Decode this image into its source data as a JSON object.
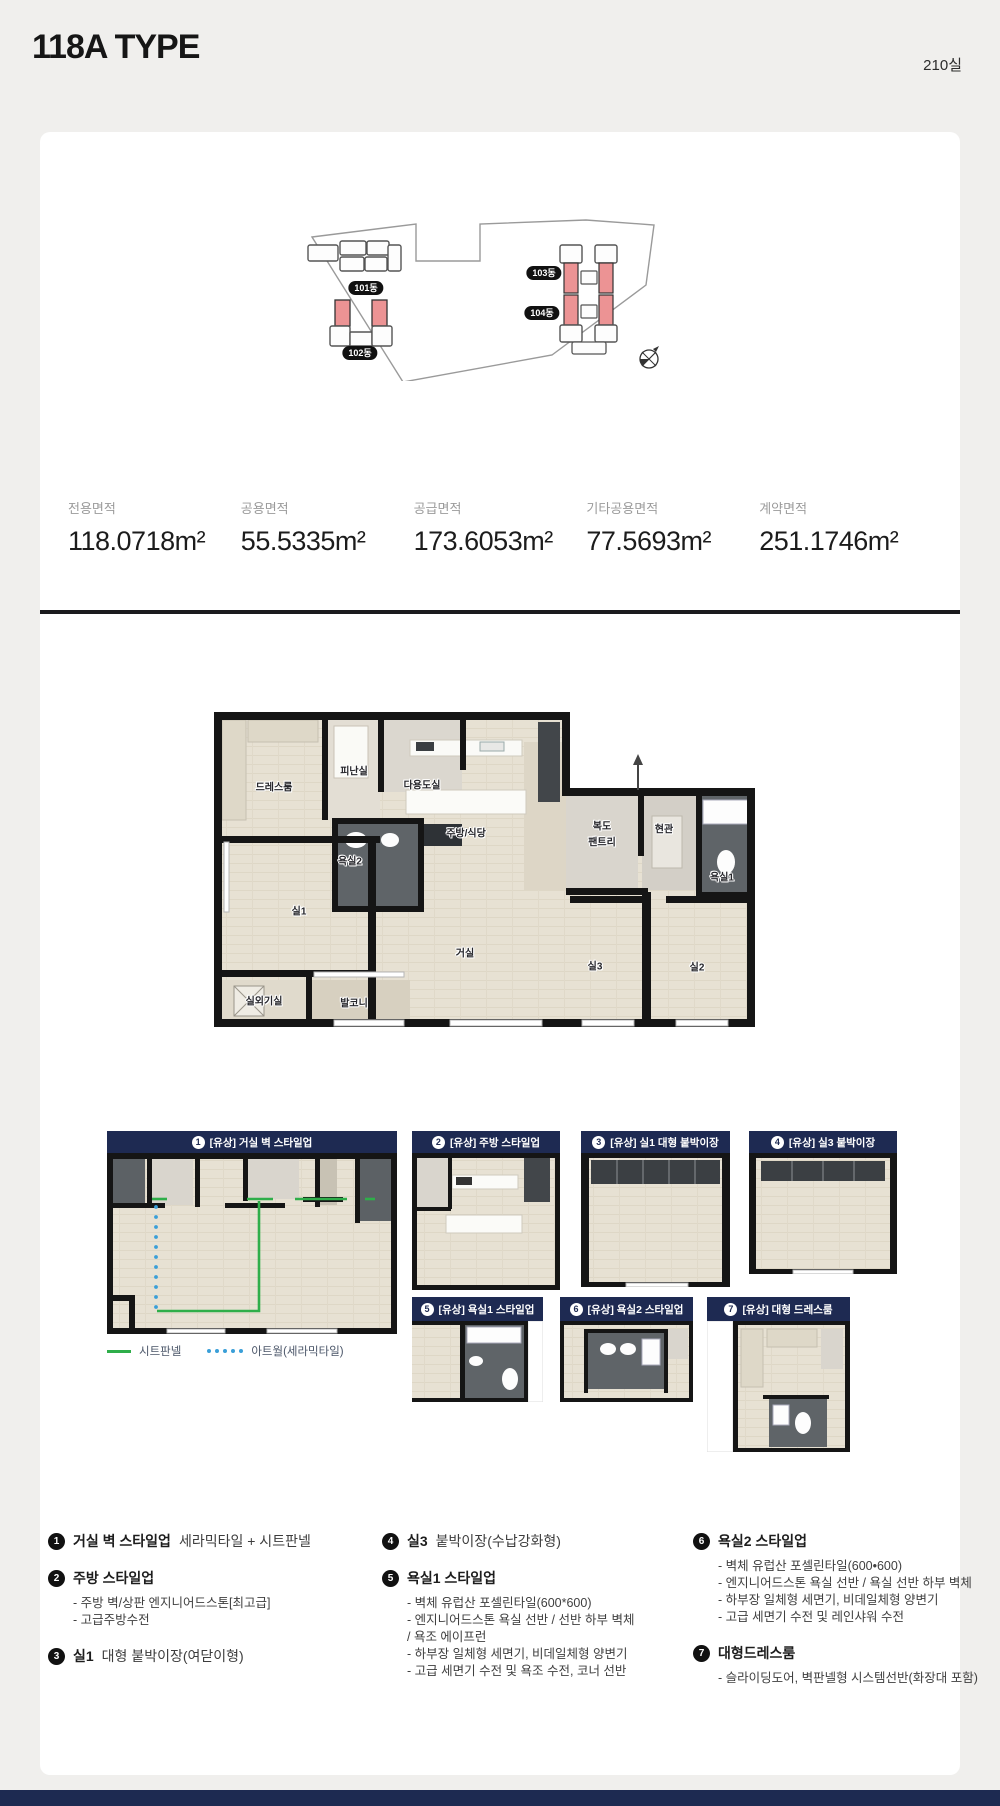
{
  "page": {
    "title": "118A TYPE",
    "unit_count": "210실"
  },
  "colors": {
    "navy": "#1e2a52",
    "highlight_red": "#ec9394",
    "green_line": "#2fae4a",
    "blue_dot": "#3a9fd8"
  },
  "site_plan": {
    "buildings": [
      {
        "label": "101동"
      },
      {
        "label": "102동"
      },
      {
        "label": "103동"
      },
      {
        "label": "104동"
      }
    ]
  },
  "specs": [
    {
      "label": "전용면적",
      "value": "118.0718m²"
    },
    {
      "label": "공용면적",
      "value": "55.5335m²"
    },
    {
      "label": "공급면적",
      "value": "173.6053m²"
    },
    {
      "label": "기타공용면적",
      "value": "77.5693m²"
    },
    {
      "label": "계약면적",
      "value": "251.1746m²"
    }
  ],
  "floor_plan": {
    "rooms": {
      "dress": "드레스룸",
      "evac": "피난실",
      "utility": "다용도실",
      "bath2": "욕실2",
      "kitchen": "주방/식당",
      "corridor": "복도",
      "pantry": "팬트리",
      "entrance": "현관",
      "bath1": "욕실1",
      "room1": "실1",
      "living": "거실",
      "room3": "실3",
      "room2": "실2",
      "ac": "실외기실",
      "balcony": "발코니"
    }
  },
  "panels": [
    {
      "no": "1",
      "title": "[유상] 거실 벽 스타일업"
    },
    {
      "no": "2",
      "title": "[유상] 주방 스타일업"
    },
    {
      "no": "3",
      "title": "[유상] 실1 대형 붙박이장"
    },
    {
      "no": "4",
      "title": "[유상] 실3 붙박이장"
    },
    {
      "no": "5",
      "title": "[유상] 욕실1 스타일업"
    },
    {
      "no": "6",
      "title": "[유상] 욕실2 스타일업"
    },
    {
      "no": "7",
      "title": "[유상] 대형 드레스룸"
    }
  ],
  "legend": [
    {
      "label": "시트판넬"
    },
    {
      "label": "아트월(세라믹타일)"
    }
  ],
  "options": [
    {
      "no": "1",
      "title": "거실 벽 스타일업",
      "subtitle": "세라믹타일 + 시트판넬",
      "details": []
    },
    {
      "no": "2",
      "title": "주방 스타일업",
      "subtitle": "",
      "details": [
        "- 주방 벽/상판 엔지니어드스톤[최고급]",
        "- 고급주방수전"
      ]
    },
    {
      "no": "3",
      "title": "실1",
      "subtitle": "대형 붙박이장(여닫이형)",
      "details": []
    },
    {
      "no": "4",
      "title": "실3",
      "subtitle": "붙박이장(수납강화형)",
      "details": []
    },
    {
      "no": "5",
      "title": "욕실1 스타일업",
      "subtitle": "",
      "details": [
        "- 벽체 유럽산 포셀린타일(600*600)",
        "- 엔지니어드스톤 욕실 선반 / 선반 하부 벽체",
        "/ 욕조 에이프런",
        "- 하부장 일체형 세면기, 비데일체형 양변기",
        "- 고급 세면기 수전 및 욕조 수전, 코너 선반"
      ]
    },
    {
      "no": "6",
      "title": "욕실2 스타일업",
      "subtitle": "",
      "details": [
        "- 벽체 유럽산 포셀린타일(600•600)",
        "- 엔지니어드스톤 욕실 선반 / 욕실 선반 하부 벽체",
        "- 하부장 일체형 세면기, 비데일체형 양변기",
        "- 고급 세면기 수전 및 레인샤워 수전"
      ]
    },
    {
      "no": "7",
      "title": "대형드레스룸",
      "subtitle": "",
      "details": [
        "- 슬라이딩도어, 벽판넬형 시스템선반(화장대 포함)"
      ]
    }
  ]
}
